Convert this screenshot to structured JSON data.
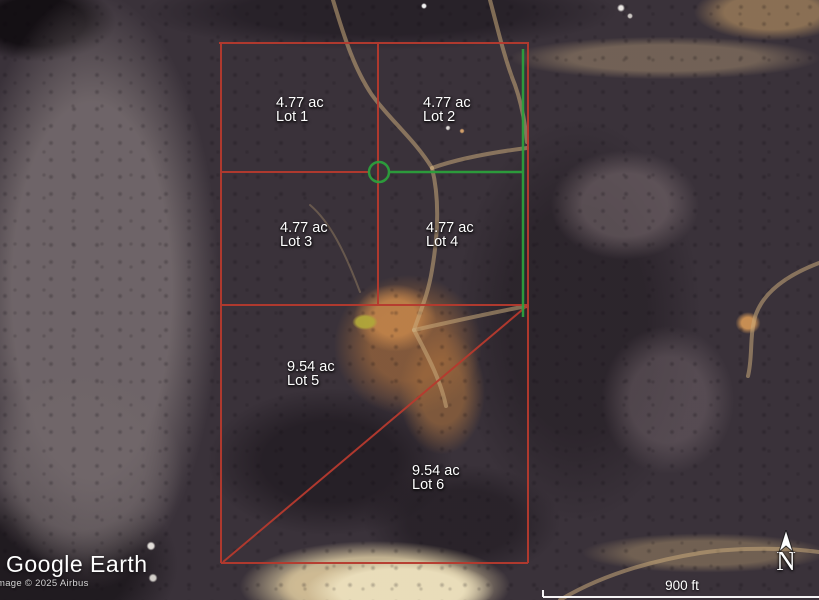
{
  "watermark": {
    "logo": "Google Earth",
    "copyright": "mage © 2025 Airbus"
  },
  "scalebar": {
    "label": "900 ft"
  },
  "compass": {
    "label": "N"
  },
  "lots": [
    {
      "acreage": "4.77 ac",
      "name": "Lot 1"
    },
    {
      "acreage": "4.77 ac",
      "name": "Lot 2"
    },
    {
      "acreage": "4.77 ac",
      "name": "Lot 3"
    },
    {
      "acreage": "4.77 ac",
      "name": "Lot 4"
    },
    {
      "acreage": "9.54 ac",
      "name": "Lot 5"
    },
    {
      "acreage": "9.54 ac",
      "name": "Lot 6"
    }
  ],
  "colors": {
    "boundary_red": "#b63a2e",
    "survey_green": "#2ca03c",
    "label_text": "#ffffff"
  }
}
